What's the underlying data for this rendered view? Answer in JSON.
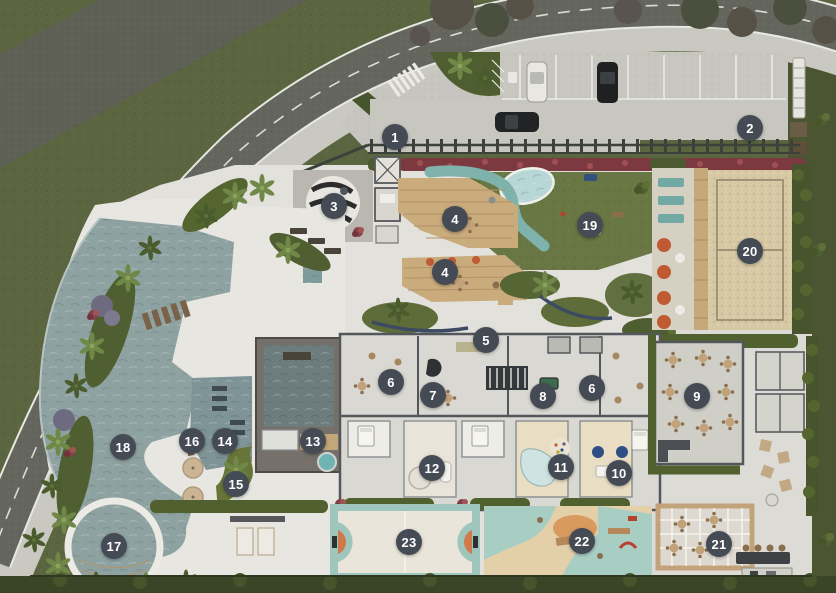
{
  "scene": {
    "type": "architectural-site-plan",
    "description": "Top-down masterplan rendering of a residential condominium ground floor with numbered amenity markers"
  },
  "palette": {
    "marker_bg": "#454b54",
    "marker_text": "#ffffff",
    "lawn": "#5b6540",
    "road_asphalt": "#64665d",
    "hardscape": "#e7e6e1",
    "pool_water": "#8fa2a2",
    "kids_pool": "#b7d6d6",
    "sand_court": "#d8c9a5",
    "deck_wood": "#c9ab7c",
    "accent_orange": "#bf5a33",
    "teal_furniture": "#72a9a4",
    "flower_hedge_red": "#7c3a40",
    "hedge_dark_green": "#47542e"
  },
  "markers": [
    {
      "label": "1",
      "x": 395,
      "y": 137
    },
    {
      "label": "2",
      "x": 750,
      "y": 128
    },
    {
      "label": "3",
      "x": 334,
      "y": 206
    },
    {
      "label": "4",
      "x": 455,
      "y": 219
    },
    {
      "label": "4",
      "x": 445,
      "y": 272
    },
    {
      "label": "5",
      "x": 486,
      "y": 340
    },
    {
      "label": "6",
      "x": 391,
      "y": 382
    },
    {
      "label": "6",
      "x": 592,
      "y": 388
    },
    {
      "label": "7",
      "x": 433,
      "y": 395
    },
    {
      "label": "8",
      "x": 543,
      "y": 396
    },
    {
      "label": "9",
      "x": 697,
      "y": 396
    },
    {
      "label": "10",
      "x": 619,
      "y": 473
    },
    {
      "label": "11",
      "x": 561,
      "y": 467
    },
    {
      "label": "12",
      "x": 432,
      "y": 468
    },
    {
      "label": "13",
      "x": 313,
      "y": 441
    },
    {
      "label": "14",
      "x": 225,
      "y": 441
    },
    {
      "label": "15",
      "x": 236,
      "y": 484
    },
    {
      "label": "16",
      "x": 192,
      "y": 441
    },
    {
      "label": "17",
      "x": 114,
      "y": 546
    },
    {
      "label": "18",
      "x": 123,
      "y": 447
    },
    {
      "label": "19",
      "x": 590,
      "y": 225
    },
    {
      "label": "20",
      "x": 750,
      "y": 251
    },
    {
      "label": "21",
      "x": 719,
      "y": 544
    },
    {
      "label": "22",
      "x": 582,
      "y": 541
    },
    {
      "label": "23",
      "x": 409,
      "y": 542
    }
  ]
}
